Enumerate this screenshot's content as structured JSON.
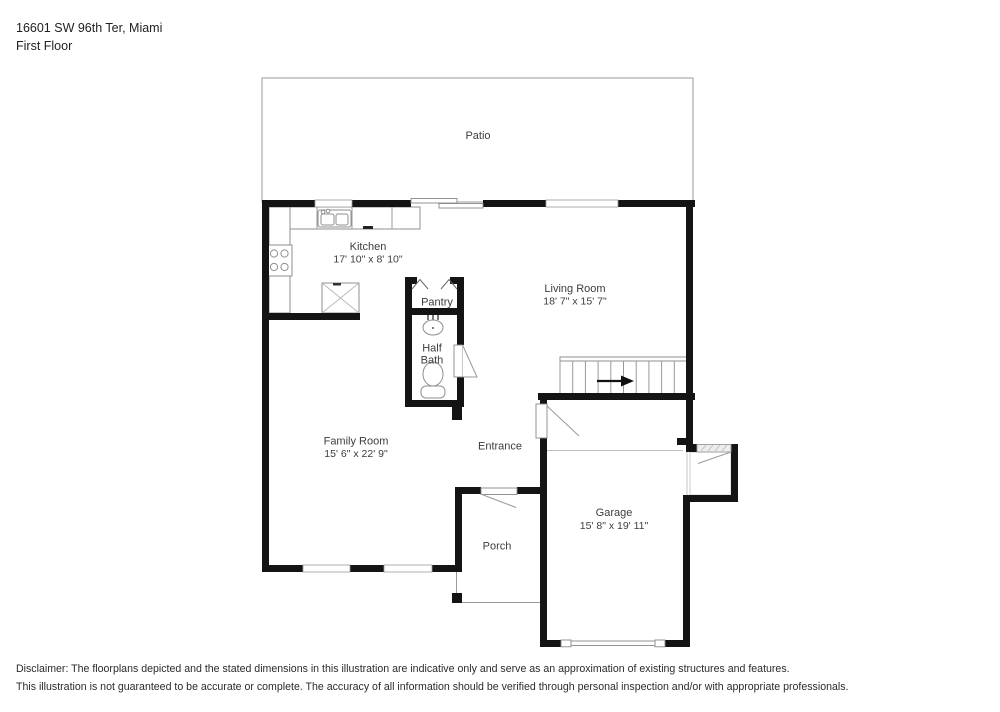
{
  "header": {
    "address": "16601 SW 96th Ter, Miami",
    "floor": "First Floor"
  },
  "rooms": {
    "patio": {
      "name": "Patio"
    },
    "kitchen": {
      "name": "Kitchen",
      "dims": "17' 10\" x 8' 10\""
    },
    "pantry": {
      "name": "Pantry"
    },
    "half_bath": {
      "line1": "Half",
      "line2": "Bath"
    },
    "living_room": {
      "name": "Living Room",
      "dims": "18' 7\" x 15' 7\""
    },
    "family_room": {
      "name": "Family Room",
      "dims": "15' 6\" x 22' 9\""
    },
    "entrance": {
      "name": "Entrance"
    },
    "porch": {
      "name": "Porch"
    },
    "garage": {
      "name": "Garage",
      "dims": "15' 8\" x 19' 11\""
    }
  },
  "disclaimer": {
    "line1": "Disclaimer: The floorplans depicted and the stated dimensions in this illustration are indicative only and serve as an approximation of existing structures and features.",
    "line2": "This illustration is not guaranteed to be accurate or complete. The accuracy of all information should be verified through personal inspection and/or with appropriate professionals."
  },
  "colors": {
    "wall": "#141414",
    "thin_line": "#9a9a9a",
    "text": "#3d3d3d"
  }
}
